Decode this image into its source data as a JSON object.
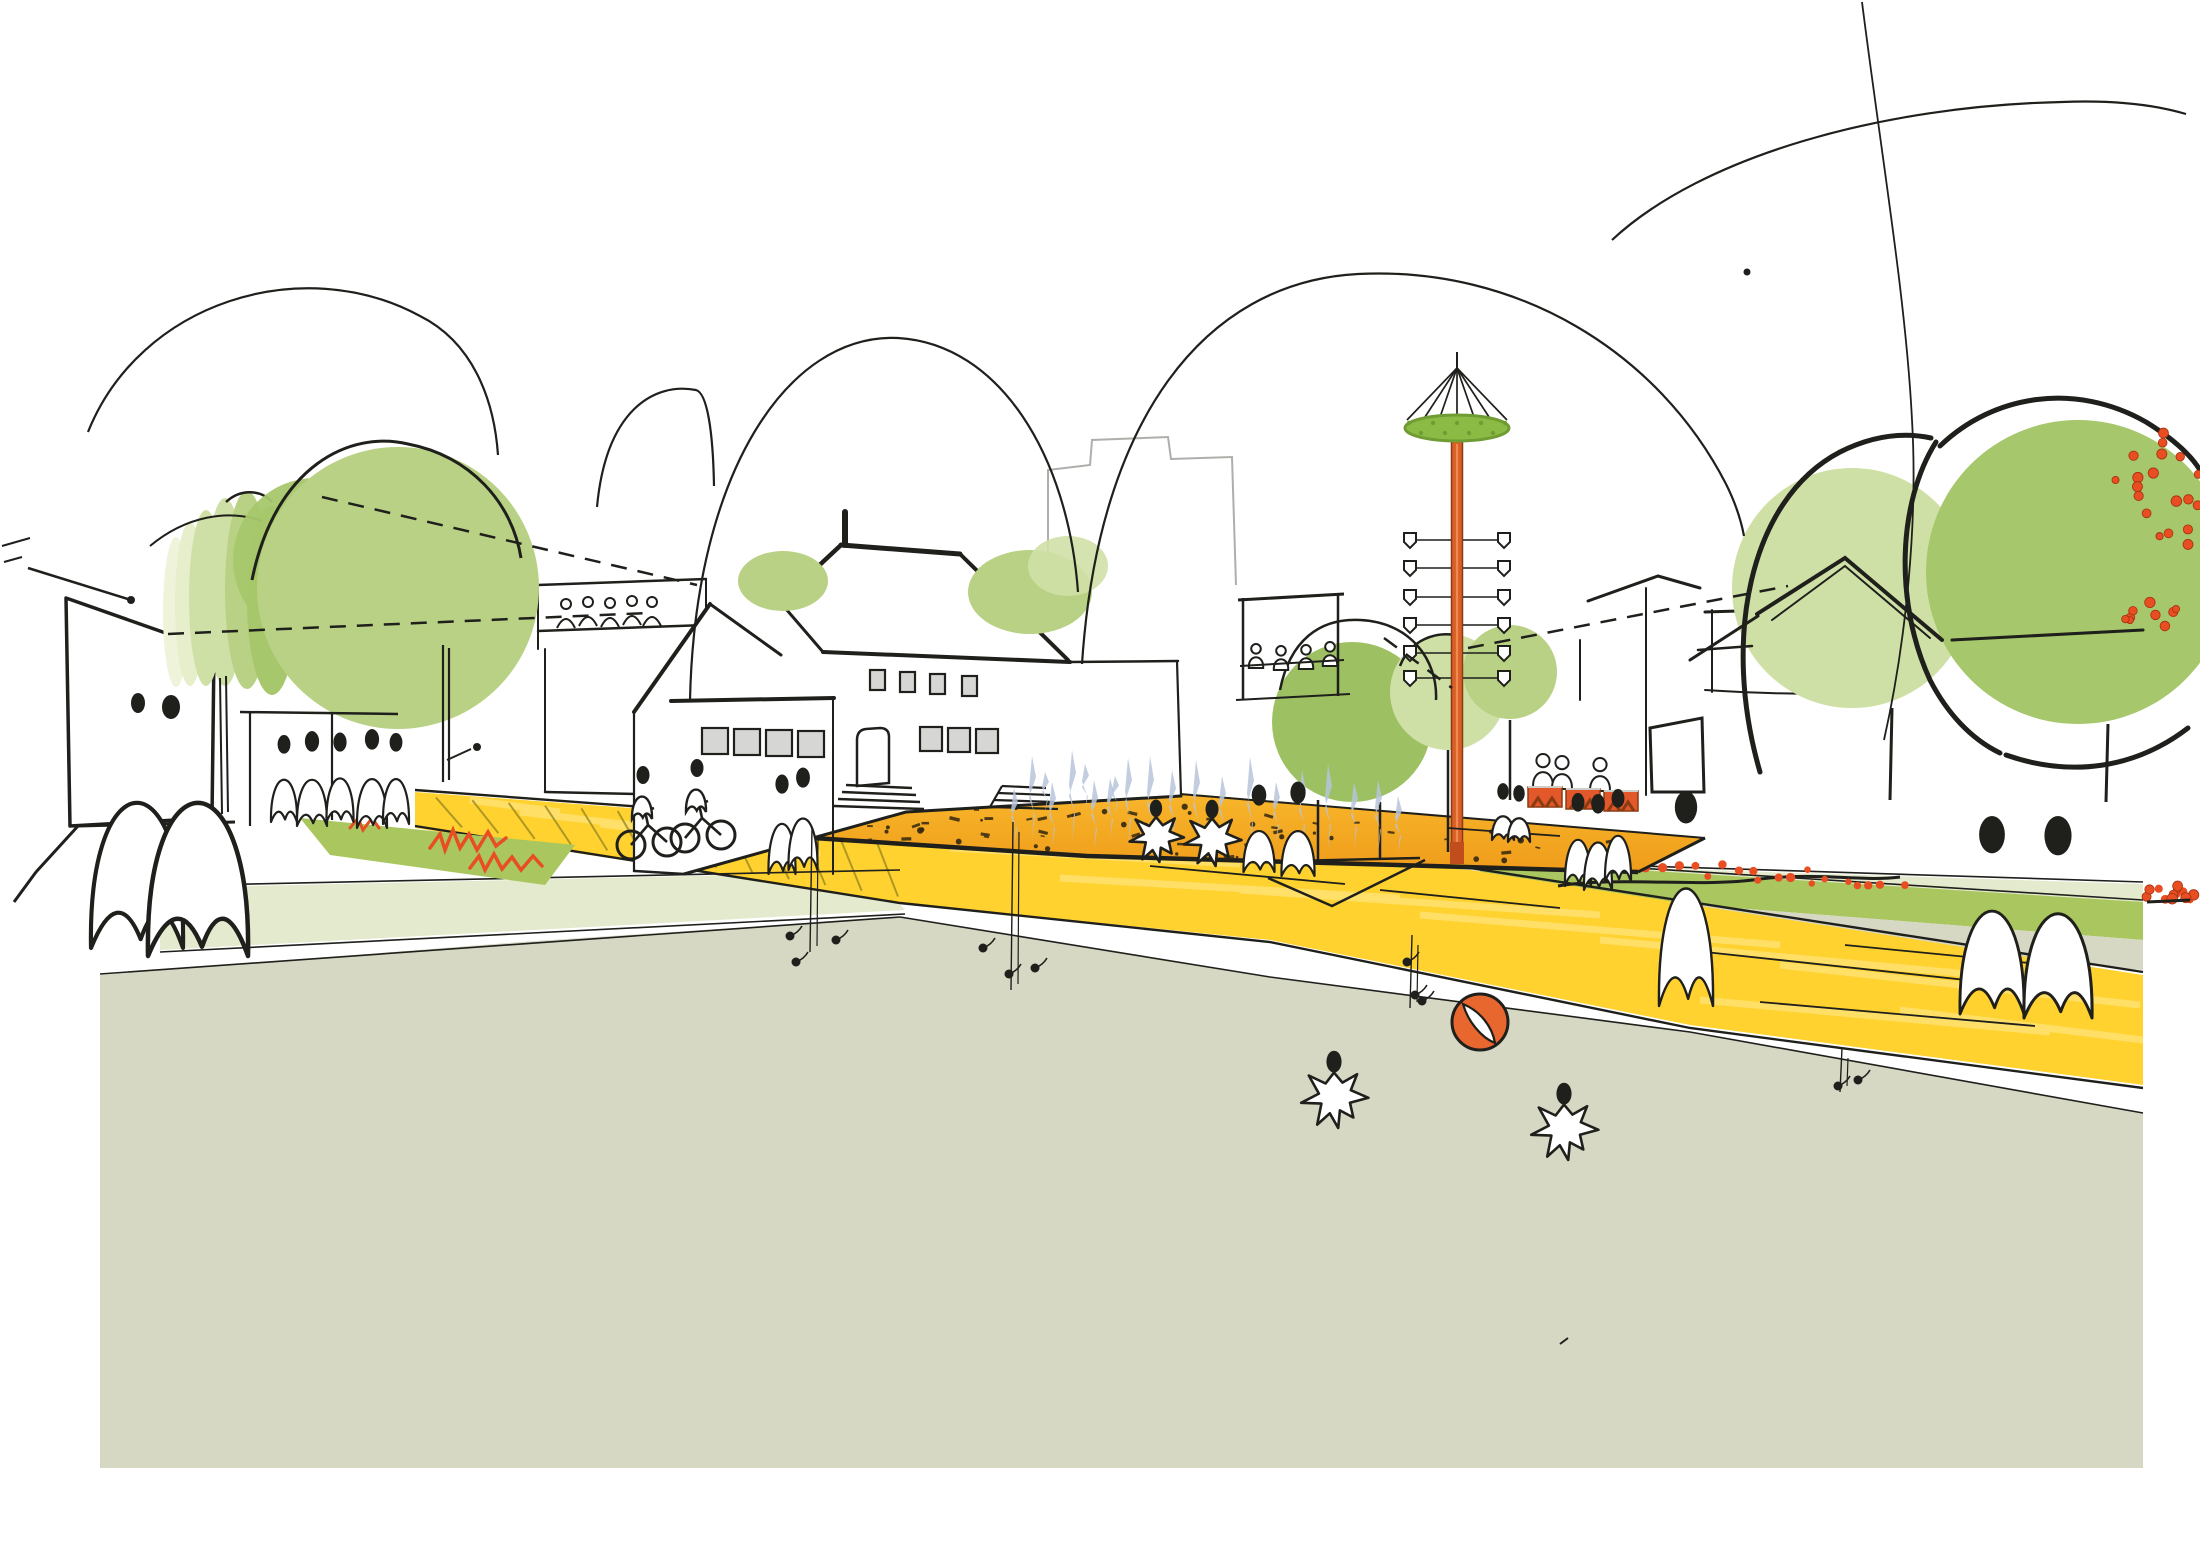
{
  "meta": {
    "alt": "Hand-drawn architectural concept sketch: village square with maypole, round trees, yellow paths, orange fountain plaza and white ghost-like figures"
  },
  "palette": {
    "page": "#ffffff",
    "ink": "#1f1f1c",
    "inkSoft": "#9a9a96",
    "ground": "#d6d8c4",
    "stripPale": "#e4eacd",
    "stripGreen": "#a9c75e",
    "treePale": "#eef3da",
    "treePale2": "#e6eecc",
    "treeLight": "#cfe0a6",
    "treeMid": "#b9d184",
    "treeDark": "#9dc162",
    "treeDeep": "#a6c76c",
    "roadYellow": "#ffd22f",
    "roadStripe": "#ffe06b",
    "hatch": "#9a8a20",
    "plazaTop": "#f8b62b",
    "plazaLow": "#ef9c1a",
    "orange": "#e2582a",
    "orangeDark": "#8a3b12",
    "ballOrange": "#e8672e",
    "poleOrange": "#d95f28",
    "poleLight": "#f08a4e",
    "flowerRed": "#e84e22",
    "fountain": "#b7c4da",
    "window": "#d6d6d4",
    "wreath": "#8cbb45",
    "wreathDark": "#6f9c33",
    "speckle": "#33270f"
  },
  "figures": {
    "ghosts": [
      {
        "x": 137,
        "y": 948,
        "w": 92,
        "h": 220,
        "head": 0
      },
      {
        "x": 198,
        "y": 956,
        "w": 100,
        "h": 232,
        "head": 0
      },
      {
        "x": 284,
        "y": 822,
        "w": 26,
        "h": 64,
        "head": 1
      },
      {
        "x": 312,
        "y": 826,
        "w": 30,
        "h": 70,
        "head": 1
      },
      {
        "x": 340,
        "y": 822,
        "w": 27,
        "h": 66,
        "head": 1
      },
      {
        "x": 372,
        "y": 828,
        "w": 30,
        "h": 74,
        "head": 1
      },
      {
        "x": 396,
        "y": 824,
        "w": 26,
        "h": 68,
        "head": 1
      },
      {
        "x": 782,
        "y": 874,
        "w": 27,
        "h": 76,
        "head": 1
      },
      {
        "x": 803,
        "y": 870,
        "w": 29,
        "h": 78,
        "head": 1
      },
      {
        "x": 1259,
        "y": 872,
        "w": 31,
        "h": 62,
        "head": 1
      },
      {
        "x": 1298,
        "y": 876,
        "w": 33,
        "h": 68,
        "head": 1
      },
      {
        "x": 1503,
        "y": 840,
        "w": 22,
        "h": 36,
        "head": 1
      },
      {
        "x": 1519,
        "y": 842,
        "w": 22,
        "h": 36,
        "head": 1
      },
      {
        "x": 1578,
        "y": 886,
        "w": 26,
        "h": 70,
        "head": 1
      },
      {
        "x": 1598,
        "y": 890,
        "w": 28,
        "h": 72,
        "head": 1
      },
      {
        "x": 1618,
        "y": 882,
        "w": 26,
        "h": 70,
        "head": 1
      },
      {
        "x": 1686,
        "y": 1006,
        "w": 54,
        "h": 178,
        "head": 1
      },
      {
        "x": 1992,
        "y": 1014,
        "w": 64,
        "h": 156,
        "head": 1
      },
      {
        "x": 2058,
        "y": 1018,
        "w": 68,
        "h": 158,
        "head": 1
      }
    ],
    "coupleEyes": [
      [
        138,
        703,
        7,
        10
      ],
      [
        171,
        707,
        9,
        12
      ]
    ],
    "starKids": [
      [
        1156,
        862,
        34
      ],
      [
        1212,
        866,
        36
      ],
      [
        1334,
        1128,
        42
      ],
      [
        1564,
        1160,
        42
      ]
    ],
    "cyclists": [
      [
        648,
        845
      ],
      [
        702,
        838
      ]
    ],
    "benchSitters": [
      [
        1543,
        787
      ],
      [
        1562,
        789
      ],
      [
        1600,
        791
      ]
    ],
    "pergolaSitters": [
      [
        1256,
        668
      ],
      [
        1281,
        670
      ],
      [
        1306,
        669
      ],
      [
        1330,
        666
      ]
    ],
    "terracePeople": [
      [
        566,
        628
      ],
      [
        588,
        626
      ],
      [
        610,
        627
      ],
      [
        632,
        625
      ],
      [
        652,
        626
      ]
    ]
  },
  "maypole": {
    "x": 1457,
    "apexY": 368,
    "wreathY": 428,
    "topY": 440,
    "baseY": 862,
    "pennantRows": [
      540,
      568,
      597,
      625,
      653,
      678
    ],
    "armLen": 35
  },
  "jets": [
    [
      1014,
      846,
      58
    ],
    [
      1032,
      840,
      84
    ],
    [
      1052,
      848,
      66
    ],
    [
      1072,
      842,
      92
    ],
    [
      1094,
      850,
      70
    ],
    [
      1110,
      838,
      60
    ],
    [
      1128,
      846,
      88
    ],
    [
      1150,
      852,
      96
    ],
    [
      1172,
      844,
      74
    ],
    [
      1196,
      850,
      90
    ],
    [
      1222,
      846,
      70
    ],
    [
      1250,
      852,
      95
    ],
    [
      1276,
      844,
      62
    ],
    [
      1302,
      850,
      80
    ],
    [
      1328,
      852,
      88
    ],
    [
      1354,
      848,
      66
    ],
    [
      1378,
      852,
      72
    ],
    [
      1398,
      854,
      58
    ],
    [
      1045,
      812,
      40
    ],
    [
      1085,
      810,
      46
    ],
    [
      1115,
      814,
      38
    ]
  ],
  "speckles": {
    "n": 90
  },
  "hatches": {
    "n": 13,
    "x0": 436,
    "x1": 872
  },
  "laneLines": [
    [
      1005,
      842,
      1160,
      856
    ],
    [
      1150,
      866,
      1345,
      884
    ],
    [
      1380,
      890,
      1560,
      908
    ],
    [
      1705,
      952,
      1985,
      982
    ],
    [
      1845,
      945,
      2080,
      968
    ],
    [
      1760,
      1002,
      2035,
      1026
    ]
  ],
  "roadStripes": [
    [
      950,
      848,
      1240,
      864
    ],
    [
      1060,
      878,
      1400,
      898
    ],
    [
      1240,
      890,
      1600,
      915
    ],
    [
      1420,
      915,
      1780,
      945
    ],
    [
      1600,
      940,
      1980,
      975
    ],
    [
      1780,
      965,
      2140,
      1005
    ],
    [
      1900,
      1010,
      2143,
      1040
    ],
    [
      1700,
      1000,
      2050,
      1032
    ],
    [
      470,
      800,
      560,
      812
    ],
    [
      520,
      812,
      640,
      826
    ],
    [
      600,
      824,
      730,
      840
    ],
    [
      680,
      836,
      820,
      854
    ]
  ],
  "hedge": [
    [
      176,
      612,
      13,
      75,
      "treePale"
    ],
    [
      190,
      604,
      15,
      82,
      "treePale2"
    ],
    [
      206,
      598,
      17,
      88,
      "treeLight"
    ],
    [
      225,
      592,
      19,
      94,
      "treeLight"
    ],
    [
      247,
      590,
      22,
      99,
      "treeMid"
    ],
    [
      272,
      600,
      25,
      95,
      "treeDeep"
    ]
  ],
  "fruitClusters": [
    {
      "cx": 2160,
      "cy": 488,
      "rx": 52,
      "ry": 68,
      "n": 20
    },
    {
      "cx": 2156,
      "cy": 616,
      "rx": 36,
      "ry": 18,
      "n": 9
    },
    {
      "cx": 2168,
      "cy": 896,
      "rx": 26,
      "ry": 11,
      "n": 8
    }
  ],
  "flowerStrip": {
    "x0": 1556,
    "x1": 1900,
    "y0": 858,
    "y1": 884,
    "n": 26
  },
  "tufts": [
    {
      "x": 812,
      "y0": 828,
      "y1": 952,
      "blobs": [
        [
          -22,
          108
        ],
        [
          24,
          112
        ],
        [
          -16,
          134
        ]
      ]
    },
    {
      "x": 1013,
      "y0": 822,
      "y1": 990,
      "blobs": [
        [
          -30,
          126
        ],
        [
          -4,
          152
        ],
        [
          22,
          146
        ]
      ]
    },
    {
      "x": 1412,
      "y0": 935,
      "y1": 1008,
      "blobs": [
        [
          -5,
          27
        ],
        [
          3,
          60
        ],
        [
          10,
          66
        ]
      ]
    },
    {
      "x": 1842,
      "y0": 1048,
      "y1": 1092,
      "blobs": [
        [
          16,
          32
        ],
        [
          -4,
          38
        ]
      ]
    }
  ],
  "ball": {
    "x": 1480,
    "y": 1022,
    "r": 28
  }
}
